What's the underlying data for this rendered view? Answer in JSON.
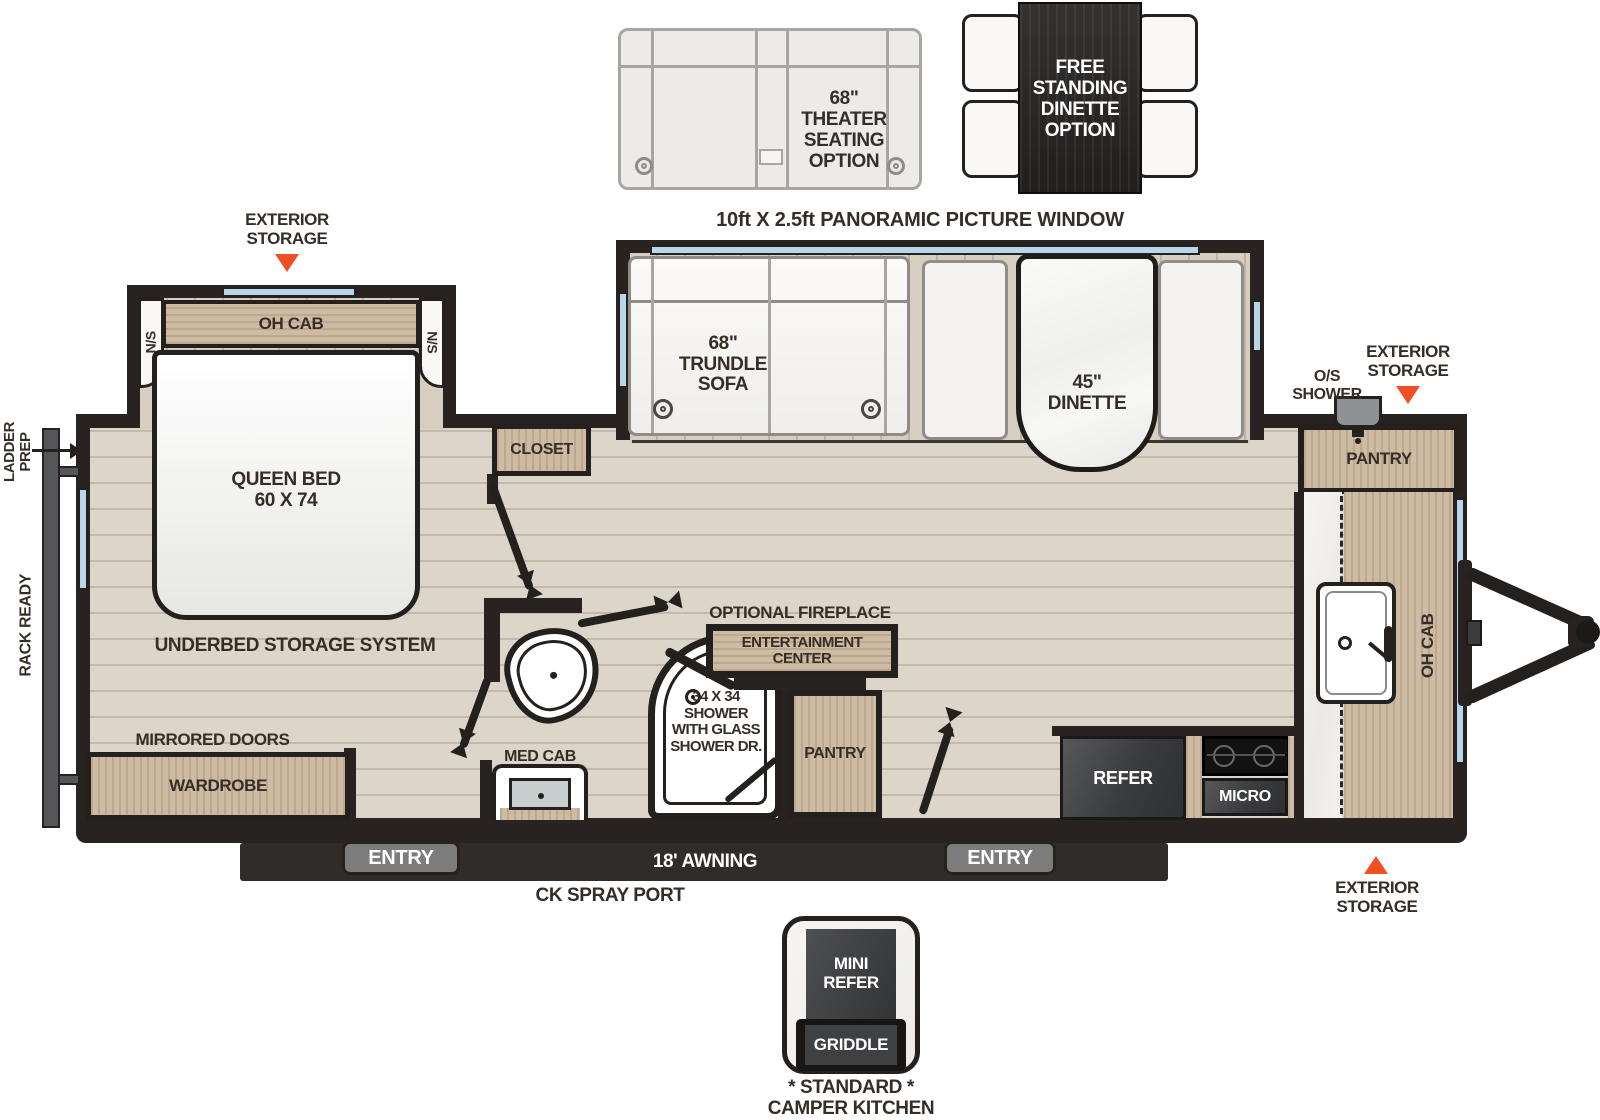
{
  "colors": {
    "accent_orange": "#F04E23",
    "window_blue": "#BAD6EA",
    "wall_black": "#282320",
    "cabinet_wood": "#CDBCA3",
    "appliance_dark": "#3D3E40",
    "floor_tan": "#DCD6CA"
  },
  "options": {
    "theater": {
      "lines": [
        "68\"",
        "THEATER",
        "SEATING",
        "OPTION"
      ]
    },
    "free_dinette": {
      "lines": [
        "FREE",
        "STANDING",
        "DINETTE",
        "OPTION"
      ]
    }
  },
  "callouts": {
    "panoramic_window": "10ft X 2.5ft PANORAMIC PICTURE WINDOW",
    "exterior_storage": {
      "lines": [
        "EXTERIOR",
        "STORAGE"
      ]
    },
    "os_shower": {
      "lines": [
        "O/S",
        "SHOWER"
      ]
    },
    "ladder_prep": {
      "lines": [
        "LADDER",
        "PREP"
      ]
    },
    "rack_ready": "RACK READY",
    "awning": "18' AWNING",
    "ck_spray_port": "CK SPRAY PORT",
    "entry": "ENTRY"
  },
  "bedroom": {
    "oh_cab": "OH CAB",
    "ns": "N/S",
    "queen_bed": {
      "lines": [
        "QUEEN BED",
        "60 X 74"
      ]
    },
    "underbed": "UNDERBED STORAGE SYSTEM",
    "mirrored_doors": "MIRRORED DOORS",
    "wardrobe": "WARDROBE",
    "closet": "CLOSET"
  },
  "living": {
    "trundle_sofa": {
      "lines": [
        "68\"",
        "TRUNDLE",
        "SOFA"
      ]
    },
    "dinette": {
      "lines": [
        "45\"",
        "DINETTE"
      ]
    }
  },
  "bath": {
    "shower": {
      "lines": [
        "34 X 34",
        "SHOWER",
        "WITH GLASS",
        "SHOWER DR."
      ]
    },
    "med_cab": "MED CAB"
  },
  "kitchen": {
    "optional_fireplace": "OPTIONAL FIREPLACE",
    "entertainment_center": {
      "lines": [
        "ENTERTAINMENT",
        "CENTER"
      ]
    },
    "pantry": "PANTRY",
    "refer": "REFER",
    "micro": "MICRO",
    "front_pantry": "PANTRY",
    "oh_cab": "OH CAB"
  },
  "camper_kitchen": {
    "mini_refer": {
      "lines": [
        "MINI",
        "REFER"
      ]
    },
    "griddle": "GRIDDLE",
    "caption": {
      "lines": [
        "* STANDARD *",
        "CAMPER KITCHEN"
      ]
    }
  }
}
